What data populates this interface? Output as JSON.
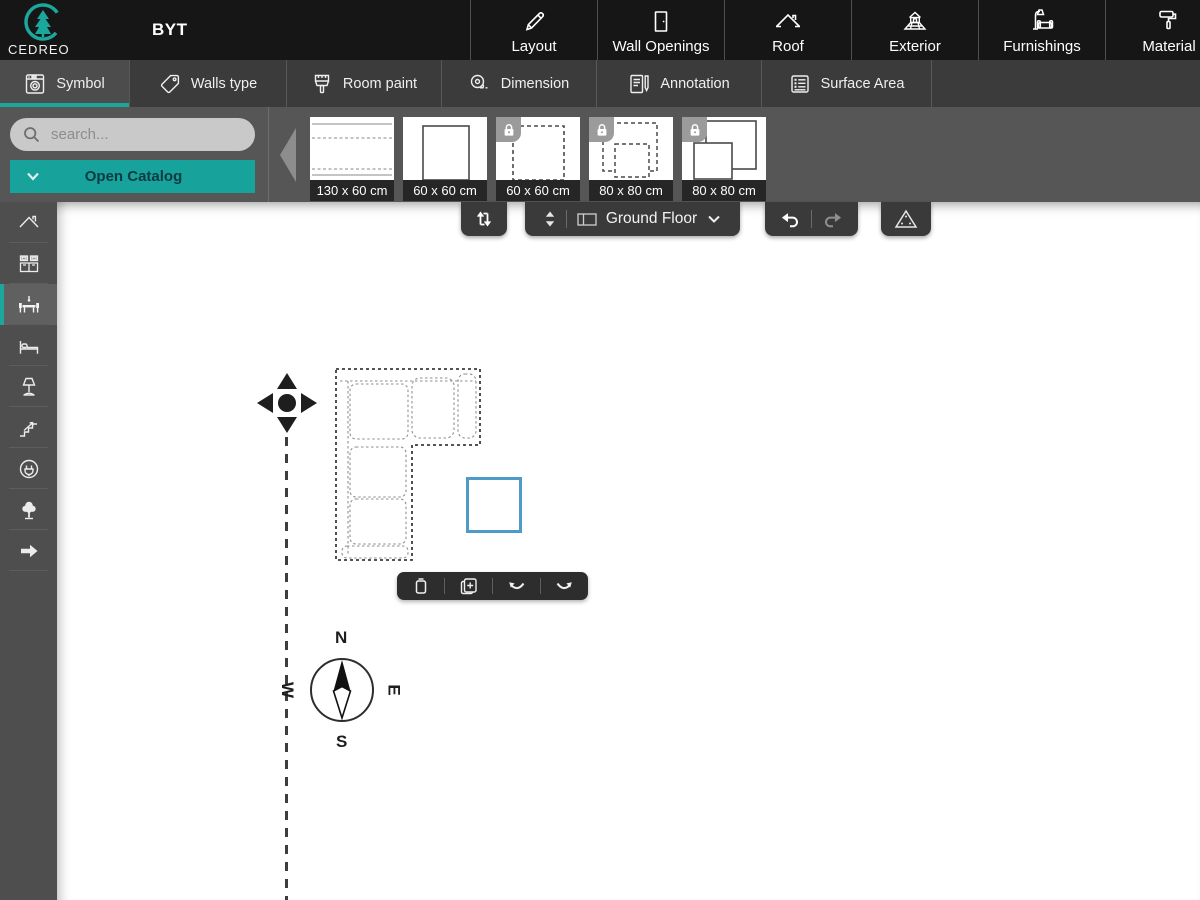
{
  "app": {
    "brand": "CEDREO",
    "project_title": "BYT"
  },
  "header": {
    "nav_items": [
      {
        "label": "Layout",
        "icon": "pencil-icon"
      },
      {
        "label": "Wall Openings",
        "icon": "door-icon"
      },
      {
        "label": "Roof",
        "icon": "roof-icon"
      },
      {
        "label": "Exterior",
        "icon": "exterior-house-icon"
      },
      {
        "label": "Furnishings",
        "icon": "lamp-sofa-icon"
      },
      {
        "label": "Material",
        "icon": "paint-roller-icon"
      }
    ]
  },
  "tabs": {
    "items": [
      {
        "label": "Symbol",
        "icon": "washing-machine-icon",
        "active": true
      },
      {
        "label": "Walls type",
        "icon": "tag-icon",
        "active": false
      },
      {
        "label": "Room paint",
        "icon": "paint-brush-icon",
        "active": false
      },
      {
        "label": "Dimension",
        "icon": "measuring-tape-icon",
        "active": false
      },
      {
        "label": "Annotation",
        "icon": "notepad-pen-icon",
        "active": false
      },
      {
        "label": "Surface Area",
        "icon": "list-icon",
        "active": false
      }
    ]
  },
  "catalog": {
    "search_placeholder": "search...",
    "open_catalog_label": "Open Catalog",
    "items": [
      {
        "size": "130 x 60 cm",
        "locked": false,
        "thumb": "rect-lines-symbol"
      },
      {
        "size": "60 x 60 cm",
        "locked": false,
        "thumb": "solid-square-symbol"
      },
      {
        "size": "60 x 60 cm",
        "locked": true,
        "thumb": "dashed-square-symbol"
      },
      {
        "size": "80 x 80 cm",
        "locked": true,
        "thumb": "double-dashed-square-symbol"
      },
      {
        "size": "80 x 80 cm",
        "locked": true,
        "thumb": "double-solid-square-symbol"
      }
    ]
  },
  "left_rail": {
    "items": [
      {
        "icon": "roof-chevron-icon",
        "selected": false
      },
      {
        "icon": "kitchen-cabinet-icon",
        "selected": false
      },
      {
        "icon": "dining-table-icon",
        "selected": true
      },
      {
        "icon": "bed-icon",
        "selected": false
      },
      {
        "icon": "lamp-icon",
        "selected": false
      },
      {
        "icon": "stairs-icon",
        "selected": false
      },
      {
        "icon": "power-outlet-icon",
        "selected": false
      },
      {
        "icon": "tree-icon",
        "selected": false
      },
      {
        "icon": "arrow-right-icon",
        "selected": false
      }
    ]
  },
  "canvas": {
    "toolbar": {
      "swap_button_icon": "swap-arrows-icon",
      "floor_selector": {
        "label": "Ground Floor",
        "spinner_icon": "up-down-spinner-icon",
        "floor_icon": "floor-plan-icon",
        "chevron_icon": "chevron-down-icon"
      },
      "undo_icon": "undo-icon",
      "redo_icon": "redo-icon",
      "triangle_button_icon": "drafting-triangle-icon"
    },
    "selection_toolbar": {
      "items": [
        {
          "icon": "trash-icon"
        },
        {
          "icon": "duplicate-icon"
        },
        {
          "icon": "rotate-ccw-icon"
        },
        {
          "icon": "rotate-cw-icon"
        }
      ]
    },
    "compass": {
      "north": "N",
      "south": "S",
      "east": "E",
      "west": "W"
    },
    "objects": {
      "sofa": "corner-sofa-symbol",
      "square": "selected-square-symbol"
    }
  },
  "colors": {
    "accent_teal": "#17a29b",
    "selection_blue": "#4f9bc8",
    "topbar": "#161616",
    "tabbar": "#3b3b3b",
    "panel_gray": "#565656"
  }
}
